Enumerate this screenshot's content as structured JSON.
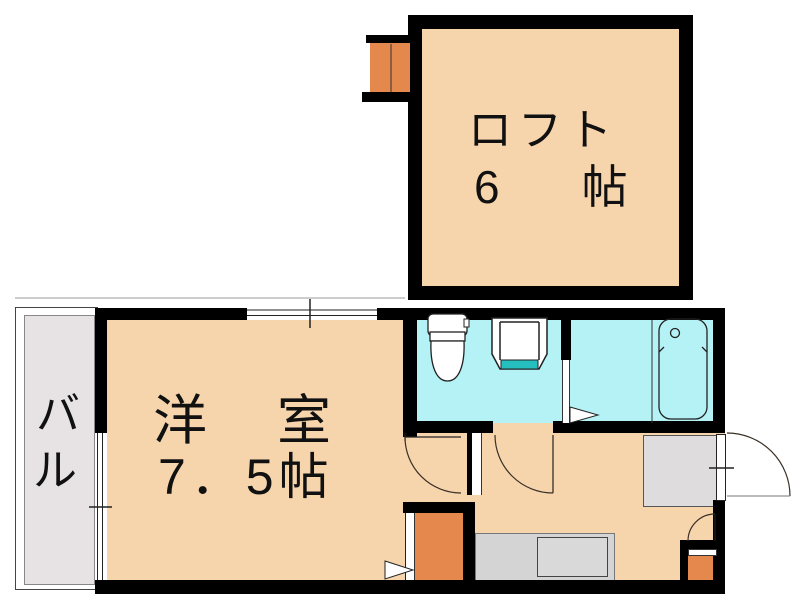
{
  "plan_title": "apartment floor plan",
  "rooms": {
    "loft": {
      "name": "ロフト",
      "size": "6　帖"
    },
    "western": {
      "name": "洋　室",
      "size": "7．5帖"
    },
    "balcony": {
      "char1": "バ",
      "char2": "ル"
    }
  },
  "fixtures": [
    "toilet",
    "washbasin",
    "bathtub",
    "entrance-door",
    "loft-ladder",
    "step-box",
    "closet-box"
  ],
  "palette": {
    "floor_peach": "#F7D5AC",
    "wet_area_cyan": "#B5F2F5",
    "step_orange": "#E5884D",
    "balcony_gray": "#E7E3E4",
    "entry_gray": "#DEDCDC",
    "counter_gray": "#D4D4D4",
    "counter_inner_gray": "#D9D9D9",
    "basin_teal": "#25BFC0",
    "wall_black": "#000000"
  }
}
